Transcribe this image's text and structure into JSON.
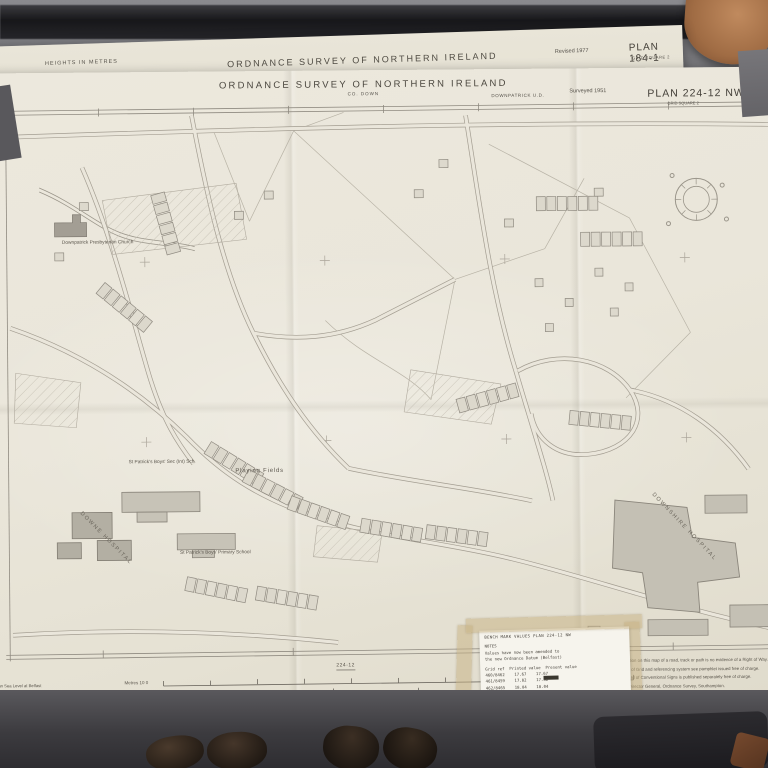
{
  "back_sheet": {
    "heights_note": "HEIGHTS IN METRES",
    "county": "CO. DOWN",
    "title": "ORDNANCE SURVEY OF NORTHERN IRELAND",
    "revision": "Revised 1977",
    "plan_number": "PLAN 184-1",
    "plan_grid": "GRID SQUARE 2"
  },
  "front_sheet": {
    "title": "ORDNANCE SURVEY OF NORTHERN IRELAND",
    "county": "CO. DOWN",
    "district": "DOWNPATRICK U.D.",
    "survey": "Surveyed 1951",
    "plan_number": "PLAN 224-12 NW",
    "plan_grid": "GRID SQUARE 2"
  },
  "map_labels": {
    "church": "Downpatrick\nPresbyterian\nChurch",
    "sec_school": "St Patrick's Boys'\nSec (Int) Sch",
    "playing_fields": "Playing Fields",
    "primary_school": "St Patrick's Boys'\nPrimary School",
    "downe_hospital": "DOWNE HOSPITAL",
    "downshire_hospital": "DOWNSHIRE HOSPITAL"
  },
  "margin": {
    "sheet_ref": "224-12",
    "datum_note": "Mean Sea Level at Belfast",
    "metres_label": "Metres 10 0",
    "feet_label": "Feet 30 0",
    "scale_label": "SCALE 1:1250"
  },
  "notice": {
    "lines": [
      "The representation on this map of a road, track or path is no evidence of a Right of Way.",
      "For explanation of Grid and referencing system see pamphlet issued free of charge.",
      "A Reference Card of Conventional Signs is published separately free of charge.",
      "Printed for the Director General, Ordnance Survey, Southampton.",
      "Published by the Ordnance Survey of Northern Ireland, Ladas Drive, Belfast, 1977.",
      "© Crown copyright"
    ]
  },
  "note_slip": {
    "header": "BENCH MARK VALUES   PLAN 224-12 NW",
    "subhead": "NOTES",
    "intro": "Values have now been amended to\nthe new Ordnance Datum (Belfast)",
    "col_header": "Grid ref  Printed value  Present value",
    "rows": [
      "460/8462    17.67    17.67",
      "461/8459    17.82    17.82",
      "462/8465    18.04    18.04",
      "463/8461    18.26    18.26",
      "464/8458    18.43    18.43",
      "465/8460    18.61    18.61",
      "466/8457    18.85    18.85",
      "467/8463    19.02    19.02"
    ]
  },
  "colors": {
    "paper": "#eae6da",
    "line_work": "#a39d91",
    "ink_text": "#55514a",
    "floor": "#6f6f73",
    "tape": "#c6b080"
  }
}
